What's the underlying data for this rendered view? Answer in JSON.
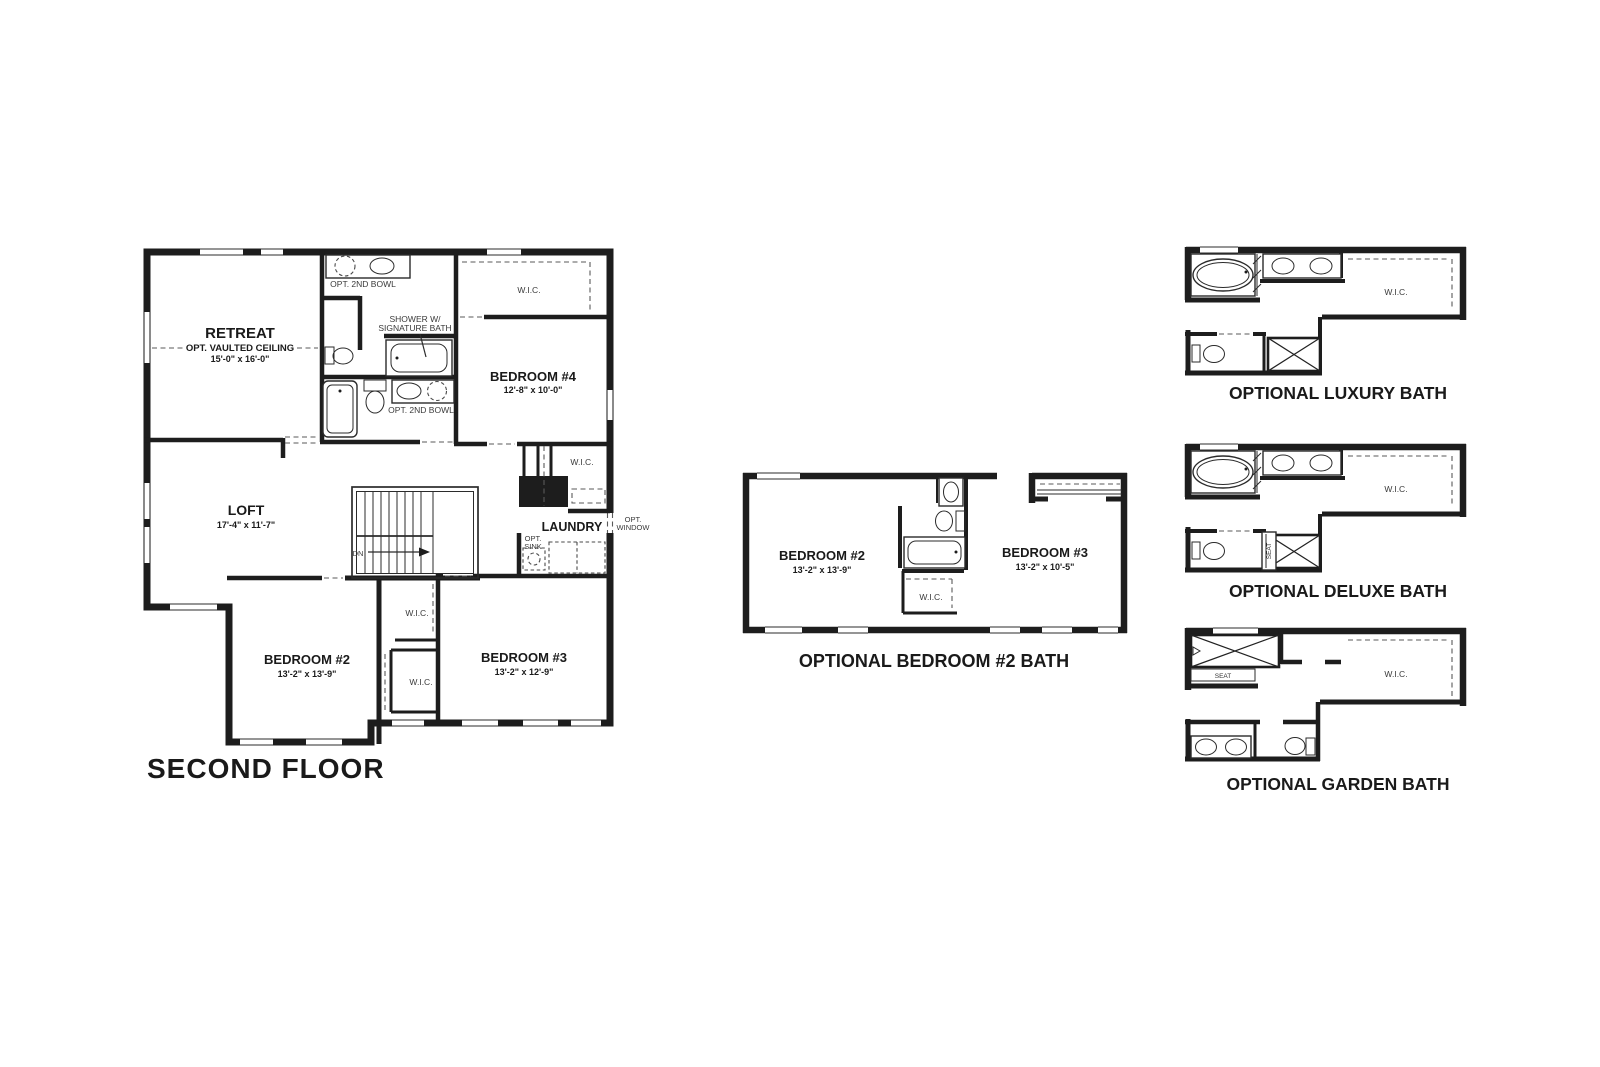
{
  "page": {
    "background": "#ffffff",
    "ink": "#1d1d1d"
  },
  "second_floor": {
    "title": "SECOND FLOOR",
    "retreat": {
      "name": "RETREAT",
      "note": "OPT. VAULTED CEILING",
      "size": "15'-0\" x 16'-0\""
    },
    "loft": {
      "name": "LOFT",
      "size": "17'-4\" x 11'-7\""
    },
    "bedroom2": {
      "name": "BEDROOM #2",
      "size": "13'-2\" x 13'-9\""
    },
    "bedroom3": {
      "name": "BEDROOM #3",
      "size": "13'-2\" x 12'-9\""
    },
    "bedroom4": {
      "name": "BEDROOM #4",
      "size": "12'-8\" x 10'-0\""
    },
    "laundry": {
      "name": "LAUNDRY"
    },
    "wic_bedroom4_closet": "W.I.C.",
    "wic_hall_closet": "W.I.C.",
    "wic_bedroom2": "W.I.C.",
    "wic_bedroom3": "W.I.C.",
    "opt_2nd_bowl_top": "OPT. 2ND BOWL",
    "opt_2nd_bowl_lower": "OPT. 2ND BOWL",
    "shower_note_line1": "SHOWER W/",
    "shower_note_line2": "SIGNATURE BATH",
    "opt_sink_line1": "OPT.",
    "opt_sink_line2": "SINK",
    "opt_window_line1": "OPT.",
    "opt_window_line2": "WINDOW",
    "stairs_down": "DN"
  },
  "optional_bedroom2_bath": {
    "caption": "OPTIONAL BEDROOM #2 BATH",
    "bedroom2": {
      "name": "BEDROOM #2",
      "size": "13'-2\" x 13'-9\""
    },
    "bedroom3": {
      "name": "BEDROOM #3",
      "size": "13'-2\" x 10'-5\""
    },
    "wic": "W.I.C."
  },
  "optional_luxury_bath": {
    "caption": "OPTIONAL LUXURY BATH",
    "wic": "W.I.C."
  },
  "optional_deluxe_bath": {
    "caption": "OPTIONAL DELUXE BATH",
    "wic": "W.I.C.",
    "seat": "SEAT"
  },
  "optional_garden_bath": {
    "caption": "OPTIONAL GARDEN BATH",
    "wic": "W.I.C.",
    "seat": "SEAT"
  }
}
